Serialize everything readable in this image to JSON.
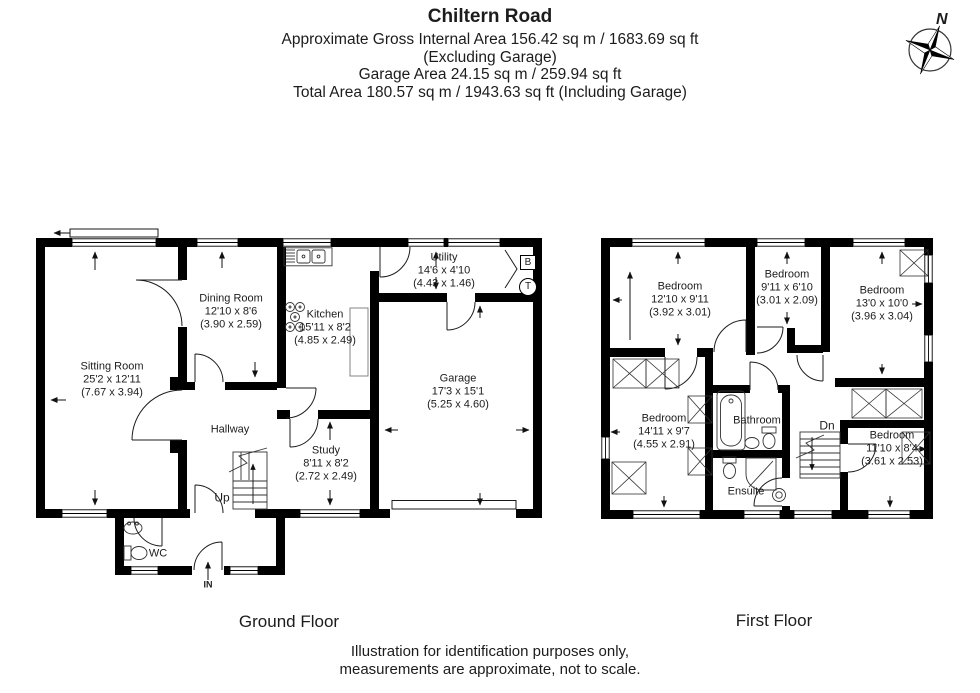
{
  "header": {
    "title": "Chiltern Road",
    "line1": "Approximate Gross Internal Area 156.42 sq m / 1683.69 sq ft",
    "line2": "(Excluding Garage)",
    "line3": "Garage Area 24.15 sq m / 259.94 sq ft",
    "line4": "Total Area 180.57 sq m / 1943.63 sq ft (Including Garage)"
  },
  "compass": {
    "label": "N"
  },
  "colors": {
    "wall": "#000000",
    "thin_line": "#1c1c1c",
    "background": "#ffffff"
  },
  "ground_floor": {
    "caption": "Ground Floor",
    "rooms": {
      "sitting": {
        "name": "Sitting Room",
        "imperial": "25'2 x 12'11",
        "metric": "(7.67 x 3.94)"
      },
      "dining": {
        "name": "Dining Room",
        "imperial": "12'10 x 8'6",
        "metric": "(3.90 x 2.59)"
      },
      "kitchen": {
        "name": "Kitchen",
        "imperial": "15'11 x 8'2",
        "metric": "(4.85 x 2.49)"
      },
      "utility": {
        "name": "Utility",
        "imperial": "14'6 x 4'10",
        "metric": "(4.43 x 1.46)"
      },
      "garage": {
        "name": "Garage",
        "imperial": "17'3 x 15'1",
        "metric": "(5.25 x 4.60)"
      },
      "hallway": {
        "name": "Hallway"
      },
      "study": {
        "name": "Study",
        "imperial": "8'11 x 8'2",
        "metric": "(2.72 x 2.49)"
      },
      "wc": {
        "name": "WC"
      },
      "stairs": {
        "name": "Up"
      },
      "entrance": {
        "name": "IN"
      }
    },
    "annotations": {
      "boiler": "B",
      "tank": "T"
    }
  },
  "first_floor": {
    "caption": "First Floor",
    "rooms": {
      "bedroom1": {
        "name": "Bedroom",
        "imperial": "12'10 x 9'11",
        "metric": "(3.92 x 3.01)"
      },
      "bedroom2": {
        "name": "Bedroom",
        "imperial": "9'11 x 6'10",
        "metric": "(3.01 x 2.09)"
      },
      "bedroom3": {
        "name": "Bedroom",
        "imperial": "13'0 x 10'0",
        "metric": "(3.96 x 3.04)"
      },
      "bedroom4": {
        "name": "Bedroom",
        "imperial": "14'11 x 9'7",
        "metric": "(4.55 x 2.91)"
      },
      "bedroom5": {
        "name": "Bedroom",
        "imperial": "11'10 x 8'4",
        "metric": "(3.61 x 2.53)"
      },
      "bathroom": {
        "name": "Bathroom"
      },
      "ensuite": {
        "name": "Ensuite"
      },
      "stairs": {
        "name": "Dn"
      }
    }
  },
  "footer": {
    "line1": "Illustration for identification purposes only,",
    "line2": "measurements are approximate, not to scale."
  }
}
